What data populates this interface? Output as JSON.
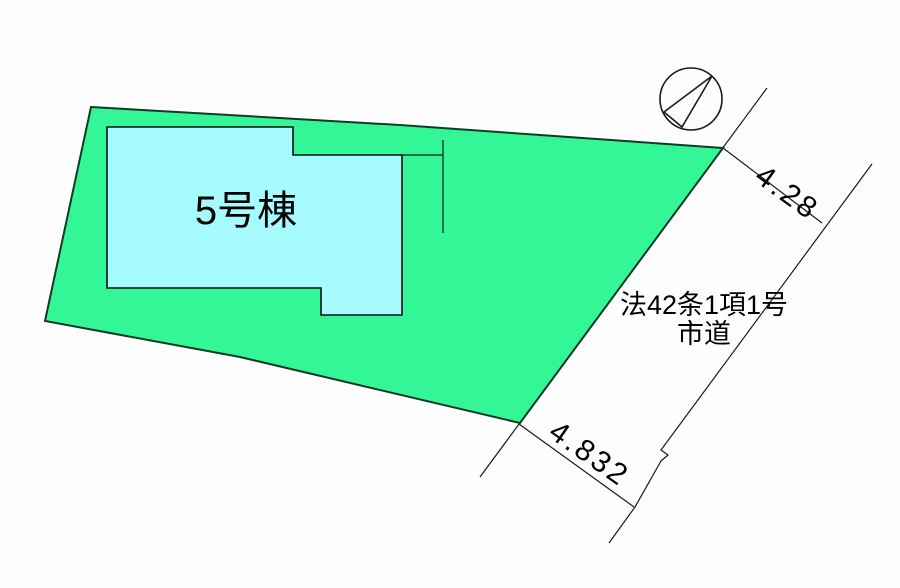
{
  "colors": {
    "background": "#FEFEFE",
    "parcel_fill": "#33F797",
    "building_fill": "#A5FBFF",
    "parcel_outline": "#123A24",
    "line_color": "#1A1A1A",
    "text_color": "#000000"
  },
  "plan": {
    "building_label": "5号棟",
    "road_regulation_line1": "法42条1項1号",
    "road_regulation_line2": "市道",
    "dimension_top": "4.28",
    "dimension_bottom": "4.832"
  },
  "icons": {
    "north_arrow": "circle-with-needle-arrow"
  }
}
